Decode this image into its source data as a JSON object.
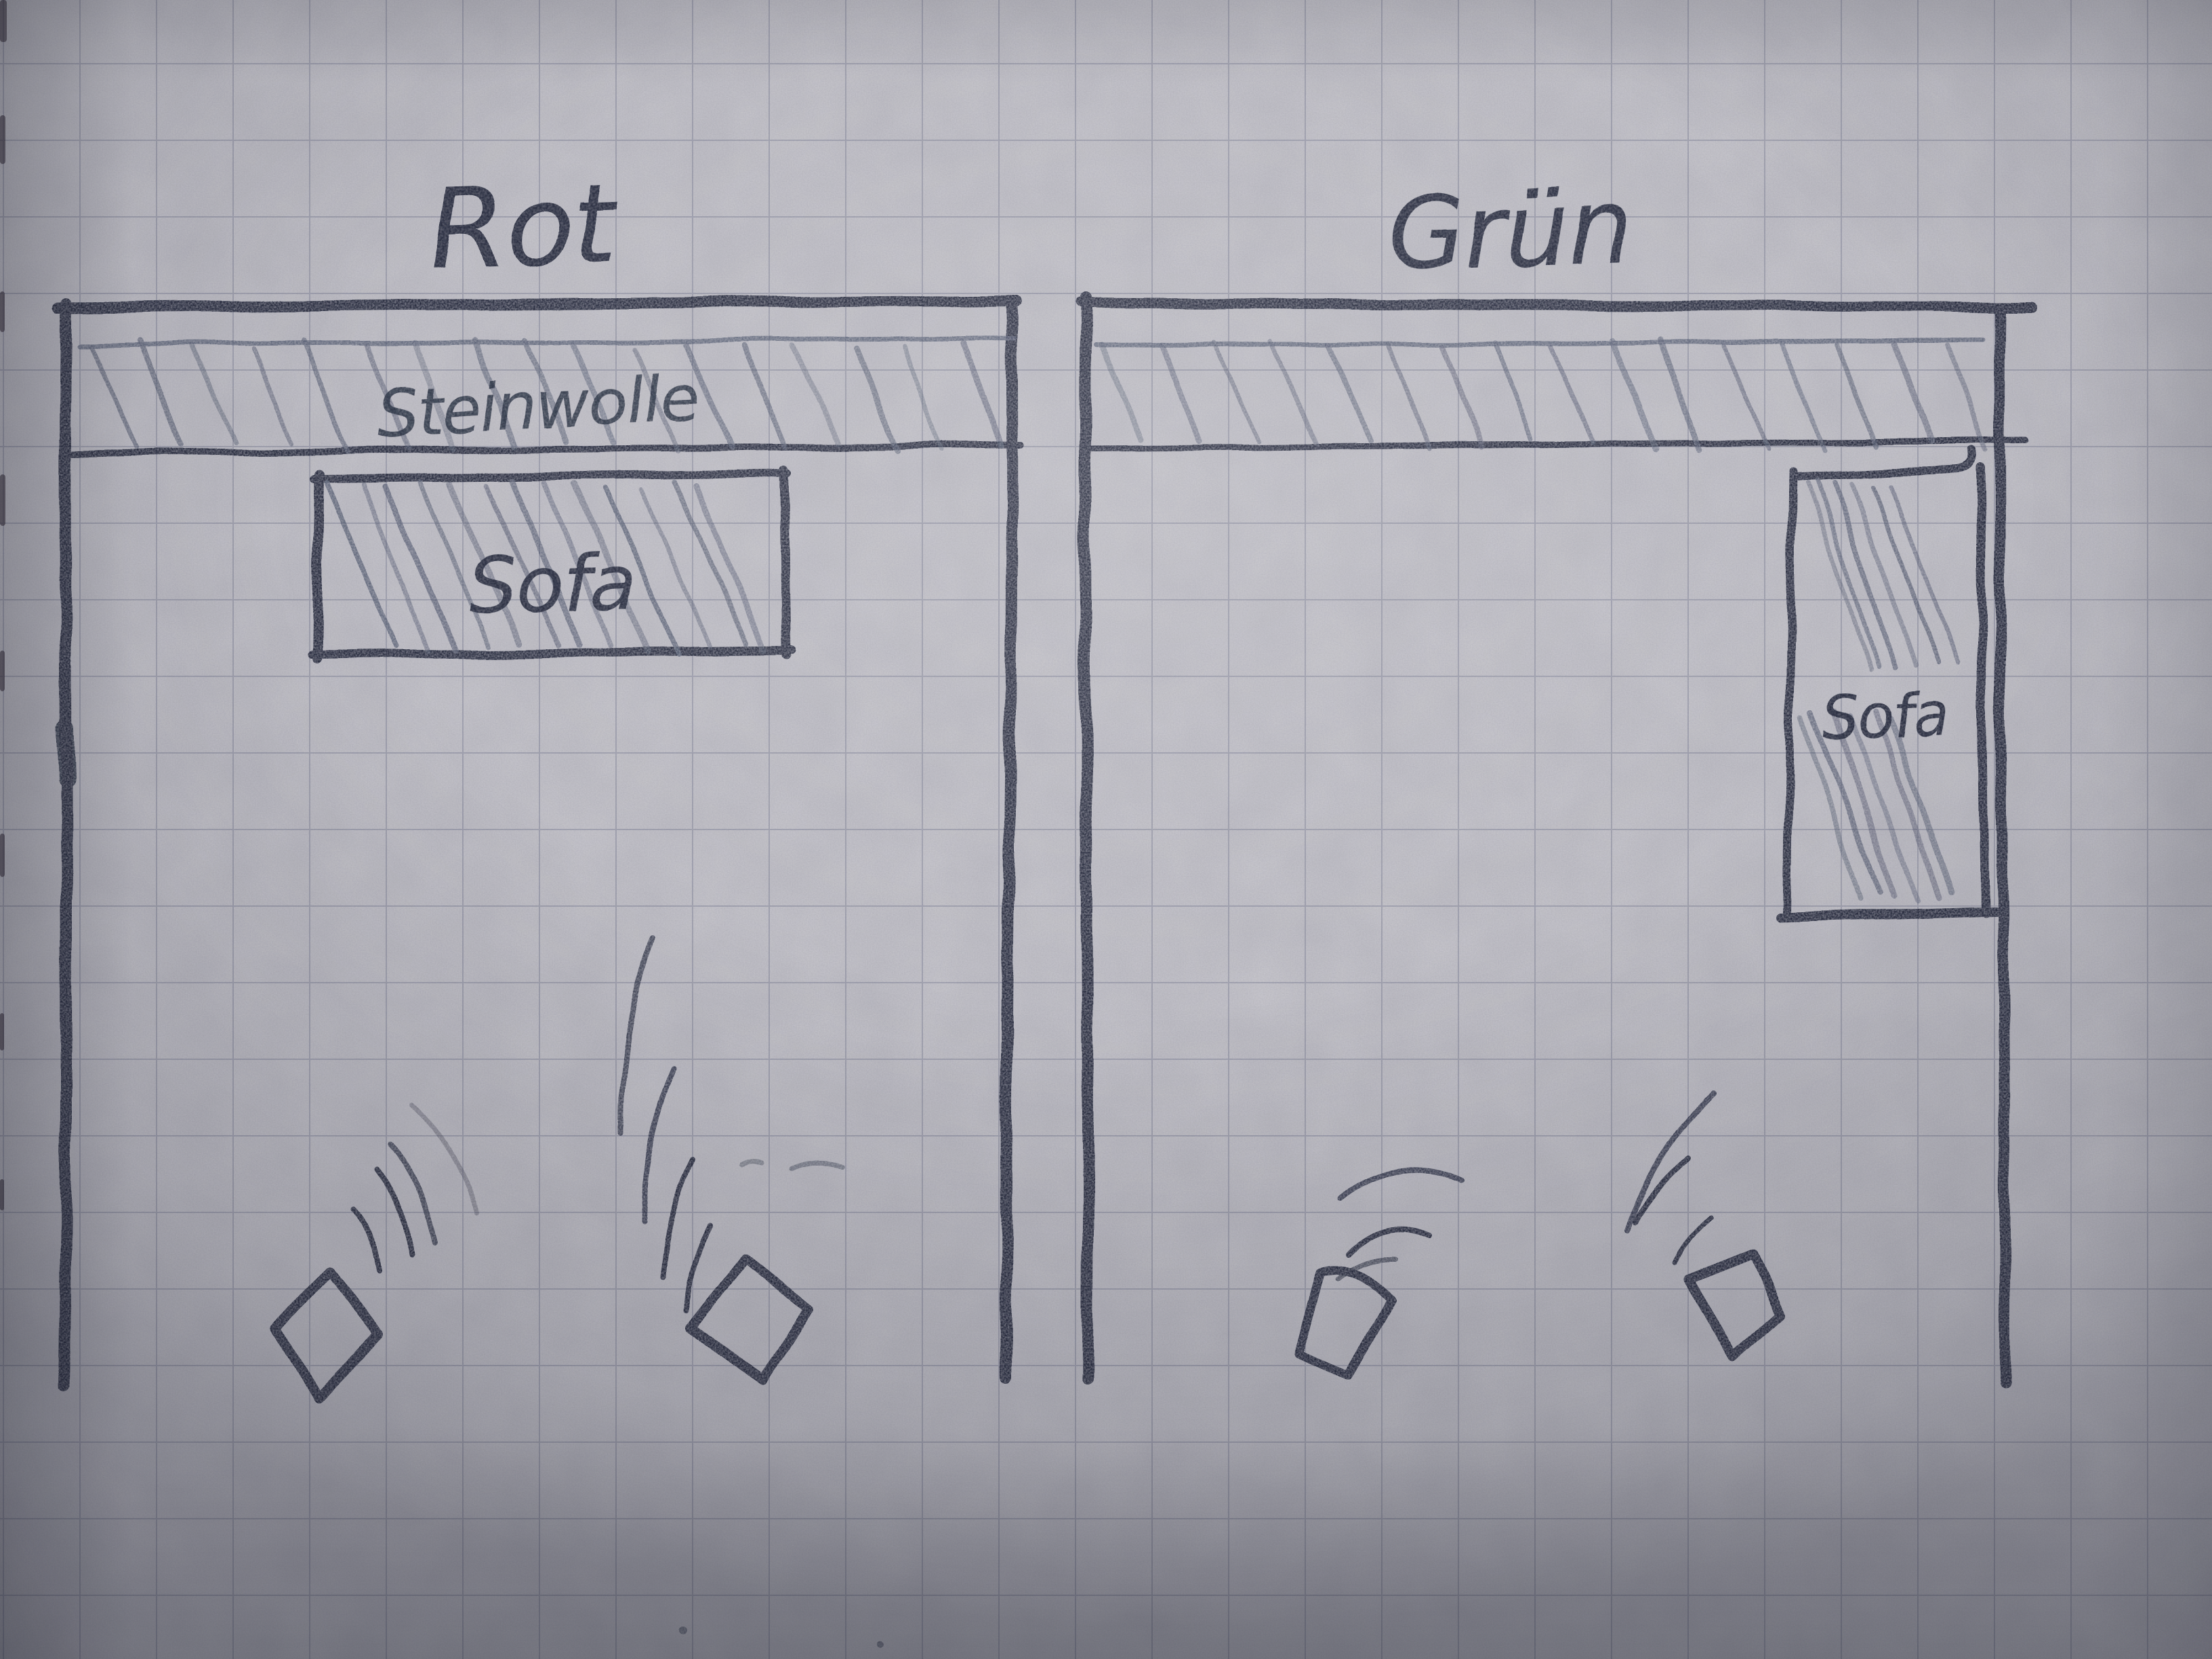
{
  "photo": {
    "description": "Hand-drawn pencil floor-plan sketch on squared paper comparing two listening rooms",
    "room_left": {
      "title": "Rot",
      "insulation_label": "Steinwolle",
      "sofa_label": "Sofa"
    },
    "room_right": {
      "title": "Grün",
      "sofa_label": "Sofa"
    }
  },
  "colors": {
    "paper": "#cac9cf",
    "grid": "#7e8498",
    "pencil": "#262c3e",
    "pencil_soft": "#535a70"
  }
}
